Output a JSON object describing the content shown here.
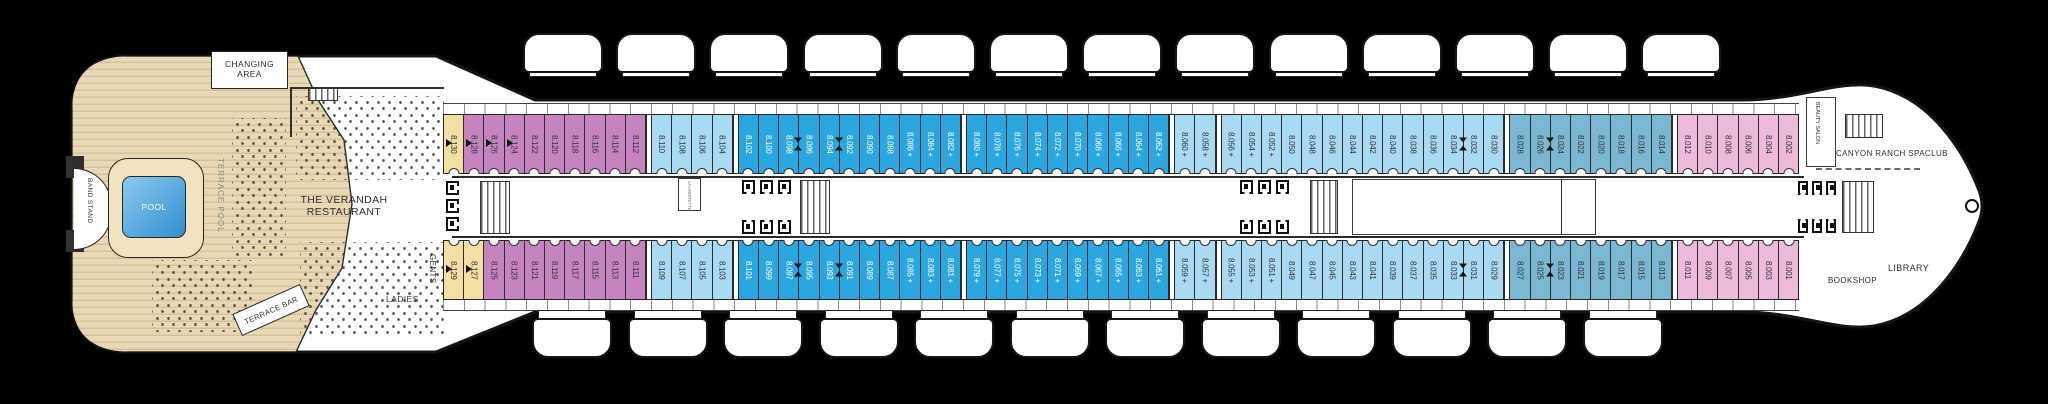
{
  "ship": {
    "deck_name": "Deck 8 plan",
    "bow_direction": "right"
  },
  "labels": {
    "changing_area": "CHANGING AREA",
    "band_stand": "BAND STAND",
    "pool": "POOL",
    "terrace_pool": "TERRACE POOL",
    "terrace_bar": "TERRACE BAR",
    "restaurant_line1": "THE VERANDAH",
    "restaurant_line2": "RESTAURANT",
    "gents": "GENTS",
    "ladies": "LADIES",
    "laundrette": "LAUNDRETTE",
    "beauty_salon": "BEAUTY SALON",
    "spa": "CANYON RANCH SPACLUB",
    "library": "LIBRARY",
    "bookshop": "BOOKSHOP"
  },
  "colors": {
    "yellow": "#f3dfa1",
    "purple": "#c584c0",
    "light_blue": "#a8dbf3",
    "blue": "#2aa6e0",
    "teal": "#79b7d3",
    "pink": "#edbadc",
    "wood": "#e8d8b5",
    "wood_stripe": "#d5c19a",
    "pool_water": "#4fa9e4"
  },
  "lifeboats": {
    "top": 13,
    "bottom": 12
  },
  "cabin_rows": {
    "top": [
      {
        "no": "8.130",
        "color": "yellow",
        "flag": true
      },
      {
        "no": "8.128",
        "color": "purple",
        "flag": true
      },
      {
        "no": "8.126",
        "color": "purple",
        "flag": true
      },
      {
        "no": "8.124",
        "color": "purple",
        "flag": true
      },
      {
        "no": "8.122",
        "color": "purple"
      },
      {
        "no": "8.120",
        "color": "purple"
      },
      {
        "no": "8.118",
        "color": "purple"
      },
      {
        "no": "8.116",
        "color": "purple"
      },
      {
        "no": "8.114",
        "color": "purple"
      },
      {
        "no": "8.112",
        "color": "purple"
      },
      {
        "divider": true
      },
      {
        "no": "8.110",
        "color": "light_blue"
      },
      {
        "no": "8.108",
        "color": "light_blue"
      },
      {
        "no": "8.106",
        "color": "light_blue"
      },
      {
        "no": "8.104",
        "color": "light_blue"
      },
      {
        "divider": true
      },
      {
        "no": "8.102",
        "color": "blue"
      },
      {
        "no": "8.100",
        "color": "blue"
      },
      {
        "no": "8.098",
        "color": "blue",
        "conn": true
      },
      {
        "no": "8.096",
        "color": "blue"
      },
      {
        "no": "8.094",
        "color": "blue",
        "conn": true
      },
      {
        "no": "8.092",
        "color": "blue"
      },
      {
        "no": "8.090",
        "color": "blue"
      },
      {
        "no": "8.088",
        "color": "blue"
      },
      {
        "no": "8.086",
        "color": "blue",
        "plus": true
      },
      {
        "no": "8.084",
        "color": "blue",
        "plus": true
      },
      {
        "no": "8.082",
        "color": "blue",
        "plus": true
      },
      {
        "divider": true
      },
      {
        "no": "8.080",
        "color": "blue",
        "plus": true
      },
      {
        "no": "8.078",
        "color": "blue",
        "plus": true
      },
      {
        "no": "8.076",
        "color": "blue",
        "plus": true
      },
      {
        "no": "8.074",
        "color": "blue",
        "plus": true
      },
      {
        "no": "8.072",
        "color": "blue",
        "plus": true
      },
      {
        "no": "8.070",
        "color": "blue",
        "plus": true
      },
      {
        "no": "8.068",
        "color": "blue",
        "plus": true
      },
      {
        "no": "8.066",
        "color": "blue",
        "plus": true
      },
      {
        "no": "8.064",
        "color": "blue",
        "plus": true
      },
      {
        "no": "8.062",
        "color": "blue",
        "plus": true
      },
      {
        "divider": true
      },
      {
        "no": "8.060",
        "color": "light_blue",
        "plus": true
      },
      {
        "no": "8.058",
        "color": "light_blue",
        "plus": true
      },
      {
        "divider": true
      },
      {
        "no": "8.056",
        "color": "light_blue",
        "plus": true
      },
      {
        "no": "8.054",
        "color": "light_blue",
        "plus": true
      },
      {
        "no": "8.052",
        "color": "light_blue",
        "plus": true
      },
      {
        "no": "8.050",
        "color": "light_blue"
      },
      {
        "no": "8.048",
        "color": "light_blue"
      },
      {
        "no": "8.046",
        "color": "light_blue"
      },
      {
        "no": "8.044",
        "color": "light_blue"
      },
      {
        "no": "8.042",
        "color": "light_blue"
      },
      {
        "no": "8.040",
        "color": "light_blue"
      },
      {
        "no": "8.038",
        "color": "light_blue"
      },
      {
        "no": "8.036",
        "color": "light_blue"
      },
      {
        "no": "8.034",
        "color": "light_blue",
        "conn": true
      },
      {
        "no": "8.032",
        "color": "light_blue"
      },
      {
        "no": "8.030",
        "color": "light_blue"
      },
      {
        "divider": true
      },
      {
        "no": "8.028",
        "color": "teal"
      },
      {
        "no": "8.026",
        "color": "teal",
        "conn": true
      },
      {
        "no": "8.024",
        "color": "teal"
      },
      {
        "no": "8.022",
        "color": "teal"
      },
      {
        "no": "8.020",
        "color": "teal"
      },
      {
        "no": "8.018",
        "color": "teal"
      },
      {
        "no": "8.016",
        "color": "teal"
      },
      {
        "no": "8.014",
        "color": "teal"
      },
      {
        "divider": true
      },
      {
        "no": "8.012",
        "color": "pink"
      },
      {
        "no": "8.010",
        "color": "pink"
      },
      {
        "no": "8.008",
        "color": "pink"
      },
      {
        "no": "8.006",
        "color": "pink"
      },
      {
        "no": "8.004",
        "color": "pink"
      },
      {
        "no": "8.002",
        "color": "pink"
      }
    ],
    "bottom": [
      {
        "no": "8.129",
        "color": "yellow",
        "flag": true
      },
      {
        "no": "8.127",
        "color": "yellow",
        "flag": true
      },
      {
        "no": "8.125",
        "color": "purple"
      },
      {
        "no": "8.123",
        "color": "purple"
      },
      {
        "no": "8.121",
        "color": "purple"
      },
      {
        "no": "8.119",
        "color": "purple"
      },
      {
        "no": "8.117",
        "color": "purple"
      },
      {
        "no": "8.115",
        "color": "purple"
      },
      {
        "no": "8.113",
        "color": "purple"
      },
      {
        "no": "8.111",
        "color": "purple"
      },
      {
        "divider": true
      },
      {
        "no": "8.109",
        "color": "light_blue"
      },
      {
        "no": "8.107",
        "color": "light_blue"
      },
      {
        "no": "8.105",
        "color": "light_blue"
      },
      {
        "no": "8.103",
        "color": "light_blue"
      },
      {
        "divider": true
      },
      {
        "no": "8.101",
        "color": "blue"
      },
      {
        "no": "8.099",
        "color": "blue"
      },
      {
        "no": "8.097",
        "color": "blue",
        "conn": true
      },
      {
        "no": "8.095",
        "color": "blue"
      },
      {
        "no": "8.093",
        "color": "blue",
        "conn": true
      },
      {
        "no": "8.091",
        "color": "blue"
      },
      {
        "no": "8.089",
        "color": "blue"
      },
      {
        "no": "8.087",
        "color": "blue"
      },
      {
        "no": "8.085",
        "color": "blue",
        "plus": true
      },
      {
        "no": "8.083",
        "color": "blue",
        "plus": true
      },
      {
        "no": "8.081",
        "color": "blue",
        "plus": true
      },
      {
        "divider": true
      },
      {
        "no": "8.079",
        "color": "blue",
        "plus": true
      },
      {
        "no": "8.077",
        "color": "blue",
        "plus": true
      },
      {
        "no": "8.075",
        "color": "blue",
        "plus": true
      },
      {
        "no": "8.073",
        "color": "blue",
        "plus": true
      },
      {
        "no": "8.071",
        "color": "blue",
        "plus": true
      },
      {
        "no": "8.069",
        "color": "blue",
        "plus": true
      },
      {
        "no": "8.067",
        "color": "blue",
        "plus": true
      },
      {
        "no": "8.065",
        "color": "blue",
        "plus": true
      },
      {
        "no": "8.063",
        "color": "blue",
        "plus": true
      },
      {
        "no": "8.061",
        "color": "blue",
        "plus": true
      },
      {
        "divider": true
      },
      {
        "no": "8.059",
        "color": "light_blue",
        "plus": true
      },
      {
        "no": "8.057",
        "color": "light_blue",
        "plus": true
      },
      {
        "divider": true
      },
      {
        "no": "8.055",
        "color": "light_blue",
        "plus": true
      },
      {
        "no": "8.053",
        "color": "light_blue",
        "plus": true
      },
      {
        "no": "8.051",
        "color": "light_blue",
        "plus": true
      },
      {
        "no": "8.049",
        "color": "light_blue"
      },
      {
        "no": "8.047",
        "color": "light_blue"
      },
      {
        "no": "8.045",
        "color": "light_blue"
      },
      {
        "no": "8.043",
        "color": "light_blue"
      },
      {
        "no": "8.041",
        "color": "light_blue"
      },
      {
        "no": "8.039",
        "color": "light_blue"
      },
      {
        "no": "8.037",
        "color": "light_blue"
      },
      {
        "no": "8.035",
        "color": "light_blue"
      },
      {
        "no": "8.033",
        "color": "light_blue",
        "conn": true
      },
      {
        "no": "8.031",
        "color": "light_blue"
      },
      {
        "no": "8.029",
        "color": "light_blue"
      },
      {
        "divider": true
      },
      {
        "no": "8.027",
        "color": "teal"
      },
      {
        "no": "8.025",
        "color": "teal",
        "conn": true
      },
      {
        "no": "8.023",
        "color": "teal"
      },
      {
        "no": "8.021",
        "color": "teal"
      },
      {
        "no": "8.019",
        "color": "teal"
      },
      {
        "no": "8.017",
        "color": "teal"
      },
      {
        "no": "8.015",
        "color": "teal"
      },
      {
        "no": "8.013",
        "color": "teal"
      },
      {
        "divider": true
      },
      {
        "no": "8.011",
        "color": "pink"
      },
      {
        "no": "8.009",
        "color": "pink"
      },
      {
        "no": "8.007",
        "color": "pink"
      },
      {
        "no": "8.005",
        "color": "pink"
      },
      {
        "no": "8.003",
        "color": "pink"
      },
      {
        "no": "8.001",
        "color": "pink"
      }
    ]
  }
}
